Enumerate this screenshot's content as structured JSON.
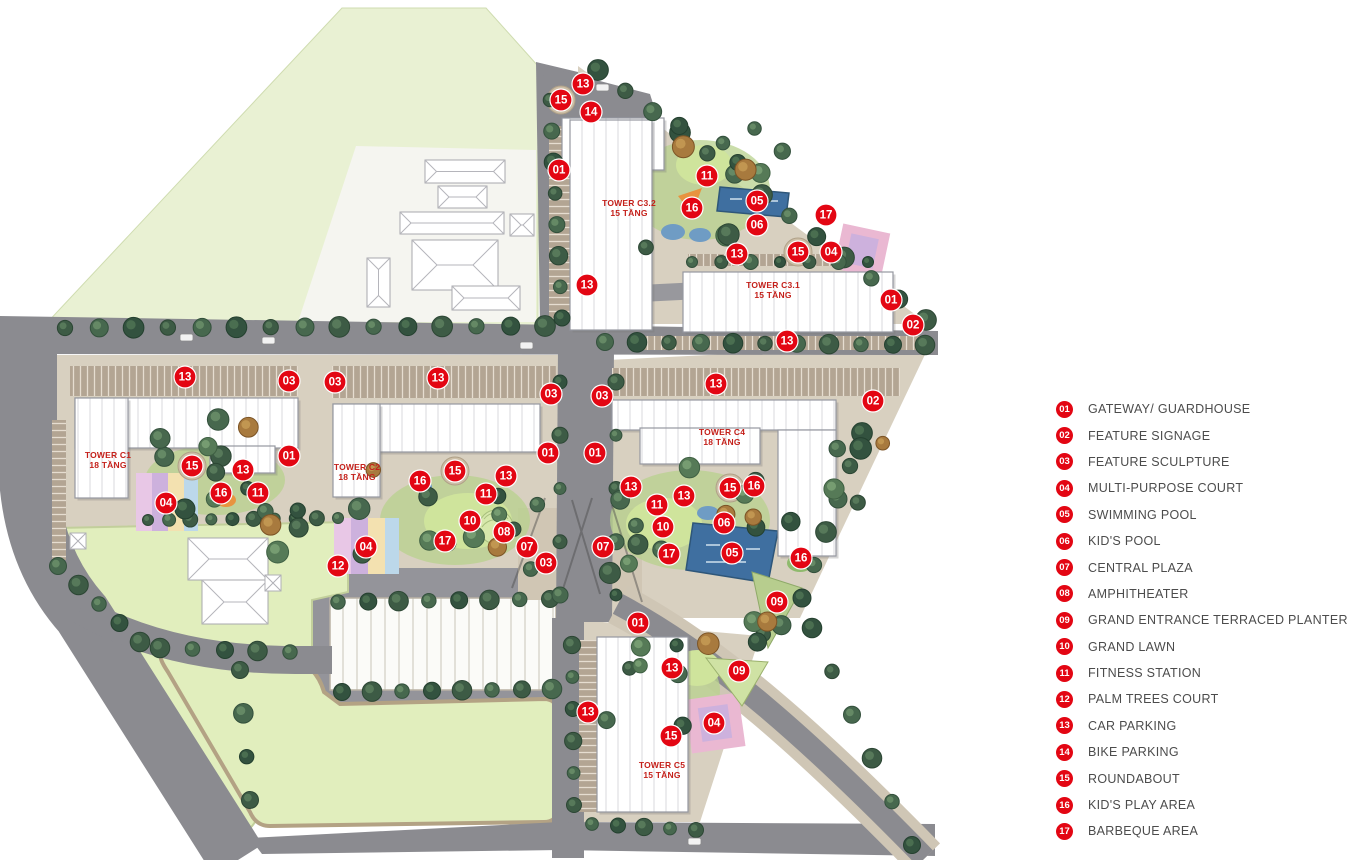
{
  "legend": {
    "items": [
      {
        "num": "01",
        "label": "GATEWAY/ GUARDHOUSE"
      },
      {
        "num": "02",
        "label": "FEATURE SIGNAGE"
      },
      {
        "num": "03",
        "label": "FEATURE SCULPTURE"
      },
      {
        "num": "04",
        "label": "MULTI-PURPOSE COURT"
      },
      {
        "num": "05",
        "label": "SWIMMING POOL"
      },
      {
        "num": "06",
        "label": "KID'S POOL"
      },
      {
        "num": "07",
        "label": "CENTRAL PLAZA"
      },
      {
        "num": "08",
        "label": "AMPHITHEATER"
      },
      {
        "num": "09",
        "label": "GRAND ENTRANCE TERRACED PLANTER"
      },
      {
        "num": "10",
        "label": "GRAND LAWN"
      },
      {
        "num": "11",
        "label": "FITNESS STATION"
      },
      {
        "num": "12",
        "label": "PALM TREES COURT"
      },
      {
        "num": "13",
        "label": "CAR PARKING"
      },
      {
        "num": "14",
        "label": "BIKE PARKING"
      },
      {
        "num": "15",
        "label": "ROUNDABOUT"
      },
      {
        "num": "16",
        "label": "KID'S PLAY AREA"
      },
      {
        "num": "17",
        "label": "BARBEQUE AREA"
      }
    ]
  },
  "map": {
    "towers": [
      {
        "name": "TOWER C1",
        "floors": "18 TẦNG",
        "x": 108,
        "y": 458
      },
      {
        "name": "TOWER C2",
        "floors": "18 TẦNG",
        "x": 357,
        "y": 470
      },
      {
        "name": "TOWER C3.1",
        "floors": "15 TẦNG",
        "x": 773,
        "y": 288
      },
      {
        "name": "TOWER C3.2",
        "floors": "15 TẦNG",
        "x": 629,
        "y": 206
      },
      {
        "name": "TOWER C4",
        "floors": "18 TẦNG",
        "x": 722,
        "y": 435
      },
      {
        "name": "TOWER C5",
        "floors": "15 TẦNG",
        "x": 662,
        "y": 768
      }
    ],
    "markers": [
      {
        "n": "13",
        "x": 583,
        "y": 84
      },
      {
        "n": "15",
        "x": 561,
        "y": 100
      },
      {
        "n": "14",
        "x": 591,
        "y": 112
      },
      {
        "n": "01",
        "x": 559,
        "y": 170
      },
      {
        "n": "11",
        "x": 707,
        "y": 176
      },
      {
        "n": "16",
        "x": 692,
        "y": 208
      },
      {
        "n": "05",
        "x": 757,
        "y": 201
      },
      {
        "n": "06",
        "x": 757,
        "y": 225
      },
      {
        "n": "17",
        "x": 826,
        "y": 215
      },
      {
        "n": "13",
        "x": 737,
        "y": 254
      },
      {
        "n": "15",
        "x": 798,
        "y": 252
      },
      {
        "n": "04",
        "x": 831,
        "y": 252
      },
      {
        "n": "13",
        "x": 587,
        "y": 285
      },
      {
        "n": "01",
        "x": 891,
        "y": 300
      },
      {
        "n": "02",
        "x": 913,
        "y": 325
      },
      {
        "n": "13",
        "x": 787,
        "y": 341
      },
      {
        "n": "13",
        "x": 185,
        "y": 377
      },
      {
        "n": "03",
        "x": 289,
        "y": 381
      },
      {
        "n": "03",
        "x": 335,
        "y": 382
      },
      {
        "n": "13",
        "x": 438,
        "y": 378
      },
      {
        "n": "03",
        "x": 551,
        "y": 394
      },
      {
        "n": "03",
        "x": 602,
        "y": 396
      },
      {
        "n": "13",
        "x": 716,
        "y": 384
      },
      {
        "n": "02",
        "x": 873,
        "y": 401
      },
      {
        "n": "01",
        "x": 289,
        "y": 456
      },
      {
        "n": "15",
        "x": 192,
        "y": 466
      },
      {
        "n": "13",
        "x": 243,
        "y": 470
      },
      {
        "n": "16",
        "x": 221,
        "y": 493
      },
      {
        "n": "11",
        "x": 258,
        "y": 493
      },
      {
        "n": "04",
        "x": 166,
        "y": 503
      },
      {
        "n": "01",
        "x": 548,
        "y": 453
      },
      {
        "n": "01",
        "x": 595,
        "y": 453
      },
      {
        "n": "15",
        "x": 455,
        "y": 471
      },
      {
        "n": "13",
        "x": 506,
        "y": 476
      },
      {
        "n": "16",
        "x": 420,
        "y": 481
      },
      {
        "n": "11",
        "x": 486,
        "y": 494
      },
      {
        "n": "10",
        "x": 470,
        "y": 521
      },
      {
        "n": "08",
        "x": 504,
        "y": 532
      },
      {
        "n": "17",
        "x": 445,
        "y": 541
      },
      {
        "n": "04",
        "x": 366,
        "y": 547
      },
      {
        "n": "12",
        "x": 338,
        "y": 566
      },
      {
        "n": "07",
        "x": 527,
        "y": 547
      },
      {
        "n": "03",
        "x": 546,
        "y": 563
      },
      {
        "n": "07",
        "x": 603,
        "y": 547
      },
      {
        "n": "13",
        "x": 631,
        "y": 487
      },
      {
        "n": "11",
        "x": 657,
        "y": 505
      },
      {
        "n": "13",
        "x": 684,
        "y": 496
      },
      {
        "n": "15",
        "x": 730,
        "y": 488
      },
      {
        "n": "16",
        "x": 754,
        "y": 486
      },
      {
        "n": "10",
        "x": 663,
        "y": 527
      },
      {
        "n": "06",
        "x": 724,
        "y": 523
      },
      {
        "n": "17",
        "x": 669,
        "y": 554
      },
      {
        "n": "05",
        "x": 732,
        "y": 553
      },
      {
        "n": "16",
        "x": 801,
        "y": 558
      },
      {
        "n": "09",
        "x": 777,
        "y": 602
      },
      {
        "n": "01",
        "x": 638,
        "y": 623
      },
      {
        "n": "13",
        "x": 672,
        "y": 668
      },
      {
        "n": "09",
        "x": 739,
        "y": 671
      },
      {
        "n": "13",
        "x": 588,
        "y": 712
      },
      {
        "n": "04",
        "x": 714,
        "y": 723
      },
      {
        "n": "15",
        "x": 671,
        "y": 736
      }
    ],
    "tree_rows": [
      {
        "x1": 65,
        "y1": 328,
        "x2": 545,
        "y2": 326,
        "n": 15,
        "r": 9
      },
      {
        "x1": 605,
        "y1": 342,
        "x2": 925,
        "y2": 345,
        "n": 11,
        "r": 8.5
      },
      {
        "x1": 598,
        "y1": 70,
        "x2": 926,
        "y2": 320,
        "n": 13,
        "r": 9
      },
      {
        "x1": 550,
        "y1": 100,
        "x2": 562,
        "y2": 318,
        "n": 8,
        "r": 8
      },
      {
        "x1": 874,
        "y1": 400,
        "x2": 802,
        "y2": 598,
        "n": 7,
        "r": 9
      },
      {
        "x1": 812,
        "y1": 628,
        "x2": 912,
        "y2": 845,
        "n": 6,
        "r": 8.5
      },
      {
        "x1": 148,
        "y1": 520,
        "x2": 338,
        "y2": 518,
        "n": 10,
        "r": 6.5
      },
      {
        "x1": 58,
        "y1": 566,
        "x2": 140,
        "y2": 642,
        "n": 5,
        "r": 8.5
      },
      {
        "x1": 160,
        "y1": 648,
        "x2": 290,
        "y2": 652,
        "n": 5,
        "r": 8.5
      },
      {
        "x1": 338,
        "y1": 602,
        "x2": 550,
        "y2": 599,
        "n": 8,
        "r": 8.5
      },
      {
        "x1": 342,
        "y1": 692,
        "x2": 552,
        "y2": 689,
        "n": 8,
        "r": 8.5
      },
      {
        "x1": 572,
        "y1": 645,
        "x2": 574,
        "y2": 805,
        "n": 6,
        "r": 7.5
      },
      {
        "x1": 592,
        "y1": 824,
        "x2": 696,
        "y2": 830,
        "n": 5,
        "r": 7.5
      },
      {
        "x1": 560,
        "y1": 382,
        "x2": 560,
        "y2": 595,
        "n": 5,
        "r": 7
      },
      {
        "x1": 616,
        "y1": 382,
        "x2": 616,
        "y2": 595,
        "n": 5,
        "r": 7
      },
      {
        "x1": 692,
        "y1": 262,
        "x2": 868,
        "y2": 262,
        "n": 7,
        "r": 6.5
      },
      {
        "x1": 240,
        "y1": 670,
        "x2": 250,
        "y2": 800,
        "n": 4,
        "r": 8.5
      }
    ],
    "tree_clusters": [
      {
        "cx": 195,
        "cy": 468,
        "w": 170,
        "h": 100,
        "n": 10,
        "seed": 11
      },
      {
        "cx": 450,
        "cy": 515,
        "w": 200,
        "h": 110,
        "n": 13,
        "seed": 23
      },
      {
        "cx": 700,
        "cy": 525,
        "w": 185,
        "h": 115,
        "n": 13,
        "seed": 37
      },
      {
        "cx": 715,
        "cy": 185,
        "w": 160,
        "h": 125,
        "n": 11,
        "seed": 41
      },
      {
        "cx": 660,
        "cy": 695,
        "w": 115,
        "h": 105,
        "n": 8,
        "seed": 53
      },
      {
        "cx": 770,
        "cy": 632,
        "w": 95,
        "h": 65,
        "n": 5,
        "seed": 67
      },
      {
        "cx": 300,
        "cy": 520,
        "w": 85,
        "h": 65,
        "n": 5,
        "seed": 71
      },
      {
        "cx": 845,
        "cy": 468,
        "w": 85,
        "h": 95,
        "n": 5,
        "seed": 83
      }
    ]
  },
  "colors": {
    "marker": "#e30613",
    "tower_label": "#c4201a",
    "legend_text": "#4c4c4c",
    "road": "#8b8b90",
    "lawn": "#e1eebd",
    "school_green": "#e9f1d3",
    "tree": "#3d5b45",
    "pool": "#3f6fa0",
    "court": "#d9b9df"
  }
}
